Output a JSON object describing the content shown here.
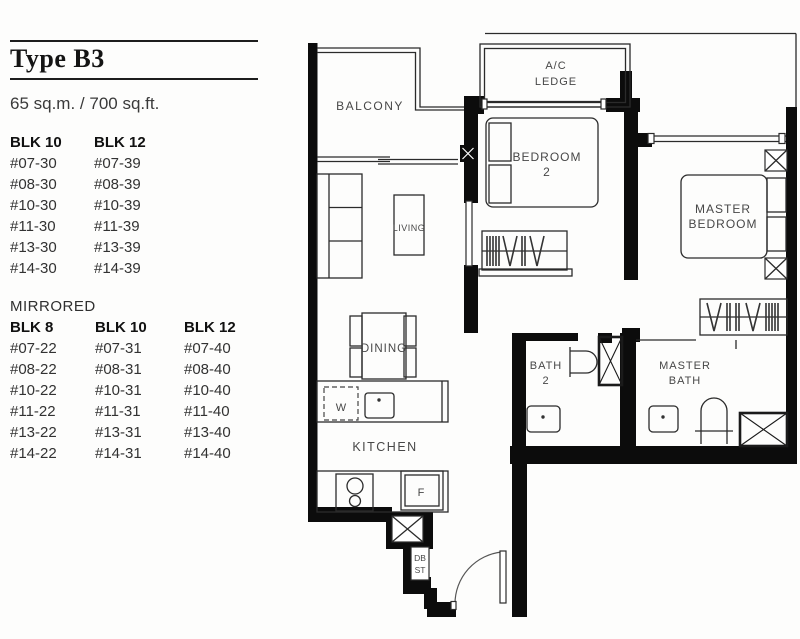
{
  "header": {
    "title": "Type B3",
    "area": "65 sq.m. / 700 sq.ft."
  },
  "units": {
    "primary": {
      "columns": [
        {
          "block": "BLK 10",
          "units": [
            "#07-30",
            "#08-30",
            "#10-30",
            "#11-30",
            "#13-30",
            "#14-30"
          ]
        },
        {
          "block": "BLK 12",
          "units": [
            "#07-39",
            "#08-39",
            "#10-39",
            "#11-39",
            "#13-39",
            "#14-39"
          ]
        }
      ]
    },
    "mirrored_label": "MIRRORED",
    "mirrored": {
      "columns": [
        {
          "block": "BLK 8",
          "units": [
            "#07-22",
            "#08-22",
            "#10-22",
            "#11-22",
            "#13-22",
            "#14-22"
          ]
        },
        {
          "block": "BLK 10",
          "units": [
            "#07-31",
            "#08-31",
            "#10-31",
            "#11-31",
            "#13-31",
            "#14-31"
          ]
        },
        {
          "block": "BLK 12",
          "units": [
            "#07-40",
            "#08-40",
            "#10-40",
            "#11-40",
            "#13-40",
            "#14-40"
          ]
        }
      ]
    }
  },
  "floorplan": {
    "labels": {
      "balcony": "BALCONY",
      "ac_line1": "A/C",
      "ac_line2": "LEDGE",
      "bedroom2_line1": "BEDROOM",
      "bedroom2_line2": "2",
      "master_bedroom_line1": "MASTER",
      "master_bedroom_line2": "BEDROOM",
      "living": "LIVING",
      "dining": "DINING",
      "kitchen": "KITCHEN",
      "bath2_line1": "BATH",
      "bath2_line2": "2",
      "master_bath_line1": "MASTER",
      "master_bath_line2": "BATH",
      "washer": "W",
      "fridge": "F",
      "db": "DB",
      "st": "ST"
    }
  }
}
